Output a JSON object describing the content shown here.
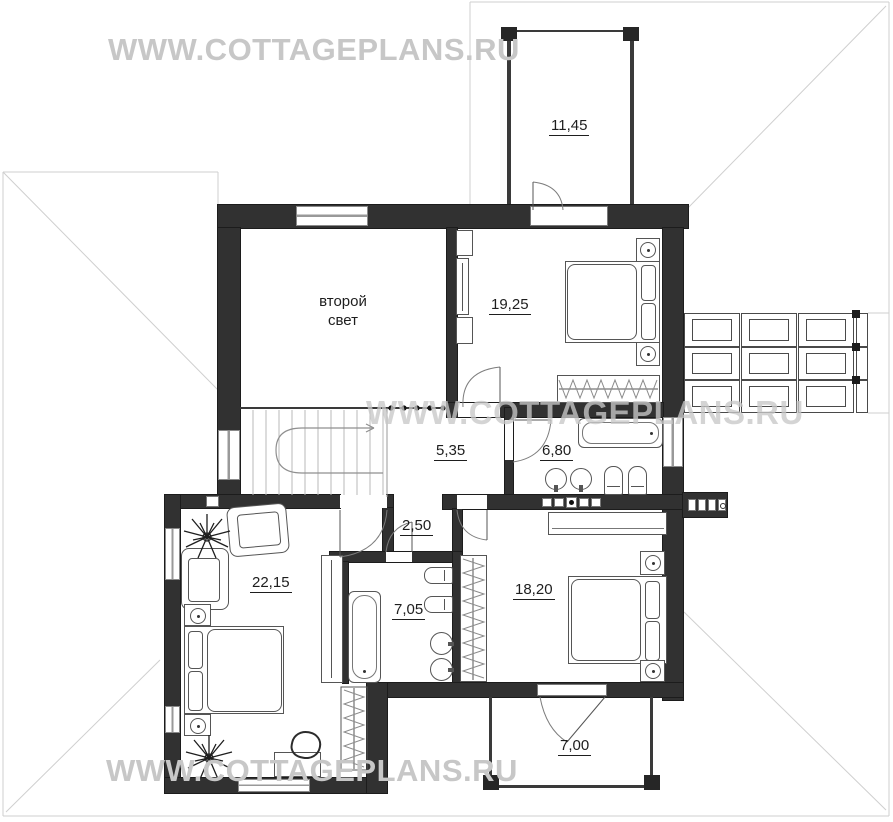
{
  "watermarks": {
    "top": "WWW.COTTAGEPLANS.RU",
    "middle": "WWW.COTTAGEPLANS.RU",
    "bottom": "WWW.COTTAGEPLANS.RU"
  },
  "rooms": [
    {
      "name": "balcony-top",
      "area": "11,45"
    },
    {
      "name": "second-light",
      "label": "второй свет"
    },
    {
      "name": "bedroom-top",
      "area": "19,25"
    },
    {
      "name": "hall",
      "area": "5,35"
    },
    {
      "name": "bathroom-main",
      "area": "6,80"
    },
    {
      "name": "corridor",
      "area": "2,50"
    },
    {
      "name": "bedroom-master",
      "area": "22,15"
    },
    {
      "name": "bathroom-master",
      "area": "7,05"
    },
    {
      "name": "bedroom-lower",
      "area": "18,20"
    },
    {
      "name": "balcony-bottom",
      "area": "7,00"
    }
  ],
  "colors": {
    "wall": "#313131",
    "roof_line": "#cfcfcf",
    "watermark": "#c7c7c7",
    "label_text": "#1e1e1e",
    "furniture_line": "#555555"
  }
}
